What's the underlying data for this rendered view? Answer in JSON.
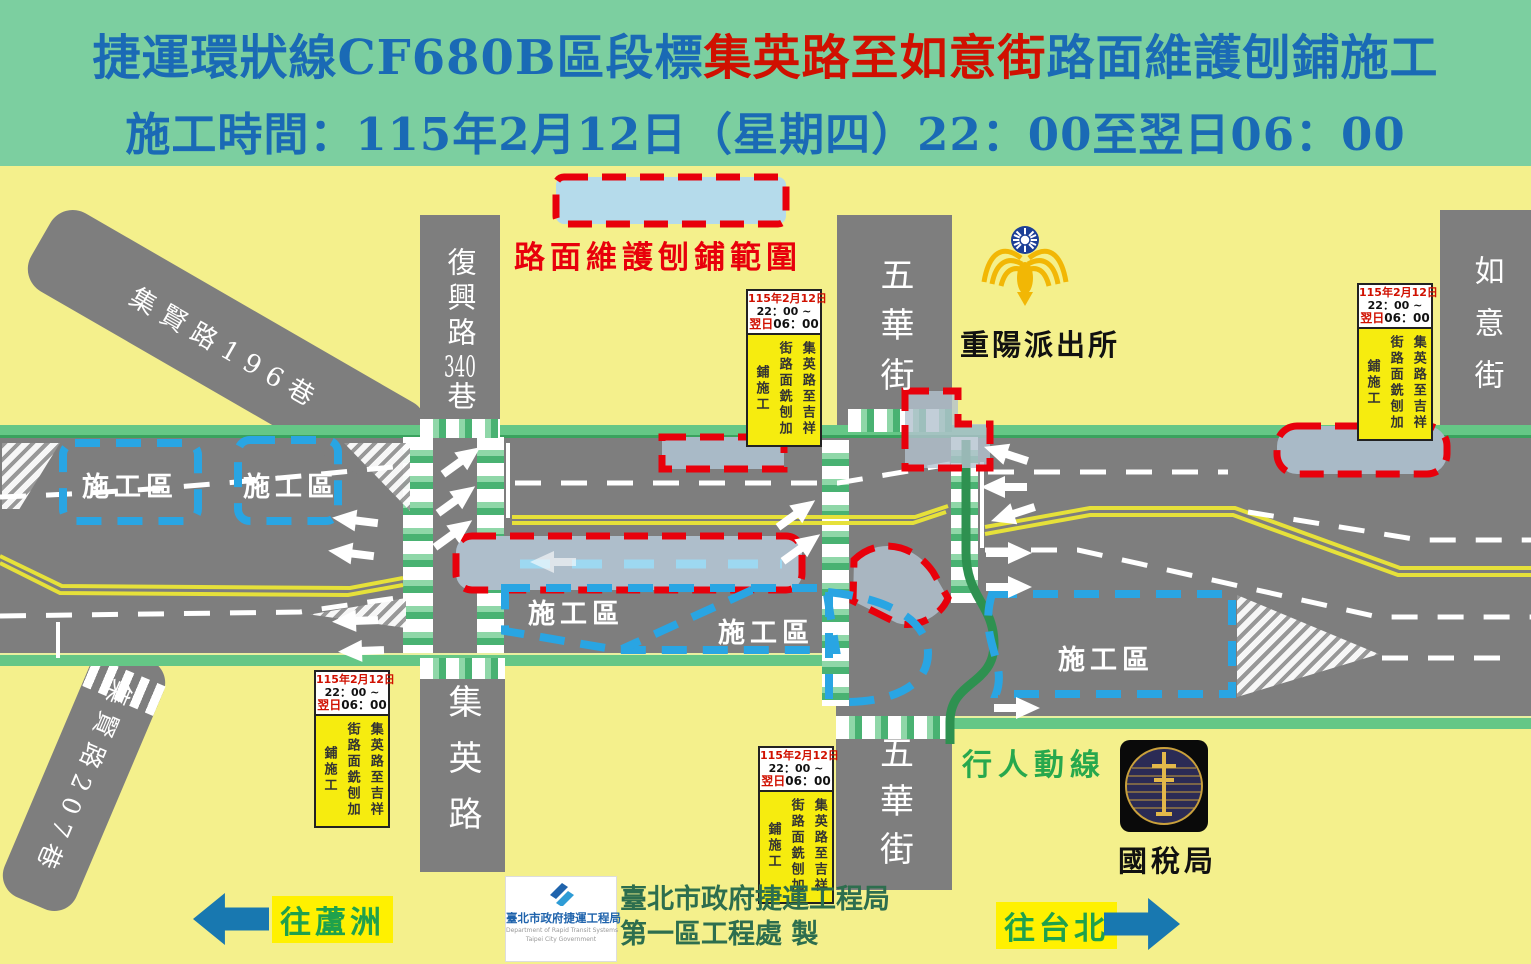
{
  "header": {
    "line1_prefix": "捷運環狀線CF680B區段標",
    "line1_highlight": "集英路至如意街",
    "line1_suffix": "路面維護刨鋪施工",
    "line2": "施工時間：115年2月12日（星期四）22：00至翌日06：00"
  },
  "legend": {
    "label": "路面維護刨鋪範圍"
  },
  "info_box": {
    "date": "115年2月12日",
    "time_start": "22：00 ~",
    "next_day": "翌日",
    "time_end": "06：00",
    "body": "集英路至吉祥街路面銑刨加鋪施工"
  },
  "roads": {
    "fuxing_pre": "復興路",
    "fuxing_num": "340",
    "fuxing_post": "巷",
    "jixian196": "集賢路196巷",
    "jixian207": "集賢路207巷",
    "jiying": "集英路",
    "wuhua": "五華街",
    "ruyi": "如意街"
  },
  "labels": {
    "construction_zone": "施工區",
    "police_station": "重陽派出所",
    "tax_bureau": "國稅局",
    "pedestrian_path": "行人動線",
    "to_luzhou": "往蘆洲",
    "to_taipei": "往台北",
    "credit_line1": "臺北市政府捷運工程局",
    "credit_line2": "第一區工程處 製"
  },
  "dorts": {
    "name_zh": "臺北市政府捷運工程局",
    "name_en1": "Department of Rapid Transit Systems",
    "name_en2": "Taipei City Government"
  },
  "colors": {
    "header_bg": "#7ccfa0",
    "title_blue": "#1a6ab5",
    "title_red": "#d01000",
    "map_bg": "#f4f08c",
    "road_gray": "#7e7e7e",
    "sidewalk_green": "#65c786",
    "red_dash": "#e8000b",
    "blue_dash": "#29a5e3",
    "milling_fill": "#aebecb",
    "legend_fill": "#b5dbeb",
    "pedestrian_green": "#2e9150",
    "direction_arrow_blue": "#1878b0",
    "highlight_yellow": "#fff100",
    "infobox_yellow": "#f6ec0f"
  }
}
